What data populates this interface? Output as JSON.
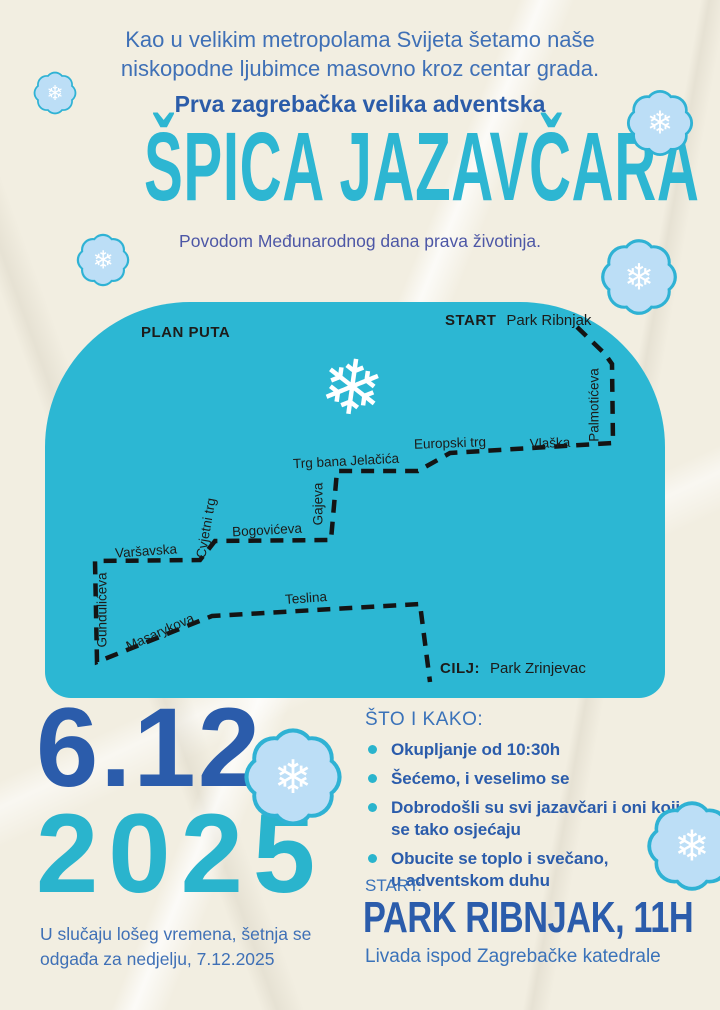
{
  "colors": {
    "paper": "#f2eee1",
    "map_teal": "#2cb7d3",
    "title_teal": "#2db6d2",
    "royal_blue": "#2b5cab",
    "sky_blue": "#3a72b9",
    "indigo": "#4d57a6",
    "ink": "#1c1c1a",
    "flake_rim": "#2fb2d4",
    "flake_fill": "#bcdef6",
    "flake_glyph": "#ffffff"
  },
  "icons": {
    "snowflake": "❄"
  },
  "header": {
    "intro": "Kao u velikim metropolama Svijeta šetamo naše\nniskopodne ljubimce masovno kroz centar grada.",
    "kicker": "Prva zagrebačka velika adventska",
    "title": "ŠPICA JAZAVČARA",
    "subtitle": "Povodom Međunarodnog dana prava životinja."
  },
  "map": {
    "heading": "PLAN PUTA",
    "start_label": "START",
    "start_value": "Park Ribnjak",
    "finish_label": "CILJ:",
    "finish_value": "Park Zrinjevac",
    "streets": {
      "palmoticeva": "Palmotićeva",
      "vlaska": "Vlaška",
      "europski_trg": "Europski trg",
      "trg_bana_jelacica": "Trg bana Jelačića",
      "gajeva": "Gajeva",
      "bogoviceva": "Bogovićeva",
      "cvjetni_trg": "Cvjetni trg",
      "varsavska": "Varšavska",
      "gunduliceva": "Gundulićeva",
      "masarykova": "Masarykova",
      "teslina": "Teslina"
    }
  },
  "date": {
    "day_month": "6.12.",
    "year": "2025"
  },
  "weather_note": "U slučaju lošeg vremena, šetnja se\nodgađa za nedjelju, 7.12.2025",
  "details": {
    "heading": "ŠTO I KAKO:",
    "bullets": [
      "Okupljanje od 10:30h",
      "Šećemo, i veselimo se",
      "Dobrodošli su svi jazavčari i oni koji\nse tako osjećaju",
      "Obucite se toplo i svečano,\nu adventskom duhu"
    ],
    "start_heading": "START:",
    "start_place": "PARK RIBNJAK, 11H",
    "start_note": "Livada ispod Zagrebačke katedrale"
  }
}
